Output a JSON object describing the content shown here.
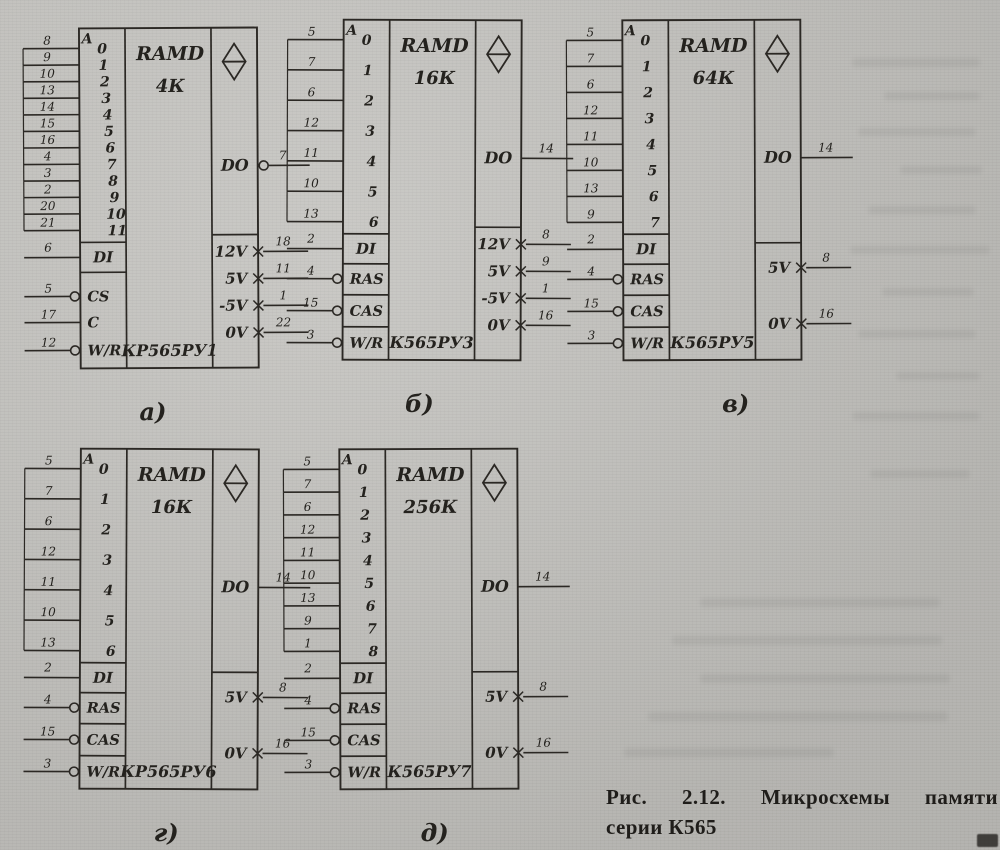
{
  "caption": {
    "line1": "Рис. 2.12. Микросхемы памяти",
    "line2": "серии К565"
  },
  "chips": [
    {
      "label": "а)",
      "type_label": "RAMD",
      "capacity": "4К",
      "part": "КР565РУ1",
      "addr_prefix": "A",
      "addresses": [
        {
          "bit": "0",
          "pin": "8"
        },
        {
          "bit": "1",
          "pin": "9"
        },
        {
          "bit": "2",
          "pin": "10"
        },
        {
          "bit": "3",
          "pin": "13"
        },
        {
          "bit": "4",
          "pin": "14"
        },
        {
          "bit": "5",
          "pin": "15"
        },
        {
          "bit": "6",
          "pin": "16"
        },
        {
          "bit": "7",
          "pin": "4"
        },
        {
          "bit": "8",
          "pin": "3"
        },
        {
          "bit": "9",
          "pin": "2"
        },
        {
          "bit": "10",
          "pin": "20"
        },
        {
          "bit": "11",
          "pin": "21"
        }
      ],
      "data_in": {
        "label": "DI",
        "pin": "6"
      },
      "controls": [
        {
          "label": "CS",
          "pin": "5",
          "circle": true
        },
        {
          "label": "C",
          "pin": "17",
          "circle": false
        },
        {
          "label": "W/R",
          "pin": "12",
          "circle": true
        }
      ],
      "boxed_controls": false,
      "data_out": {
        "label": "DO",
        "pin": "7",
        "circle": true
      },
      "power": [
        {
          "label": "12V",
          "pin": "18"
        },
        {
          "label": "5V",
          "pin": "11"
        },
        {
          "label": "-5V",
          "pin": "1"
        },
        {
          "label": "0V",
          "pin": "22"
        }
      ]
    },
    {
      "label": "б)",
      "type_label": "RAMD",
      "capacity": "16К",
      "part": "К565РУ3",
      "addr_prefix": "A",
      "addresses": [
        {
          "bit": "0",
          "pin": "5"
        },
        {
          "bit": "1",
          "pin": "7"
        },
        {
          "bit": "2",
          "pin": "6"
        },
        {
          "bit": "3",
          "pin": "12"
        },
        {
          "bit": "4",
          "pin": "11"
        },
        {
          "bit": "5",
          "pin": "10"
        },
        {
          "bit": "6",
          "pin": "13"
        }
      ],
      "data_in": {
        "label": "DI",
        "pin": "2"
      },
      "controls": [
        {
          "label": "RAS",
          "pin": "4",
          "circle": true
        },
        {
          "label": "CAS",
          "pin": "15",
          "circle": true
        },
        {
          "label": "W/R",
          "pin": "3",
          "circle": true
        }
      ],
      "boxed_controls": true,
      "data_out": {
        "label": "DO",
        "pin": "14",
        "circle": false
      },
      "power": [
        {
          "label": "12V",
          "pin": "8"
        },
        {
          "label": "5V",
          "pin": "9"
        },
        {
          "label": "-5V",
          "pin": "1"
        },
        {
          "label": "0V",
          "pin": "16"
        }
      ]
    },
    {
      "label": "в)",
      "type_label": "RAMD",
      "capacity": "64К",
      "part": "К565РУ5",
      "addr_prefix": "A",
      "addresses": [
        {
          "bit": "0",
          "pin": "5"
        },
        {
          "bit": "1",
          "pin": "7"
        },
        {
          "bit": "2",
          "pin": "6"
        },
        {
          "bit": "3",
          "pin": "12"
        },
        {
          "bit": "4",
          "pin": "11"
        },
        {
          "bit": "5",
          "pin": "10"
        },
        {
          "bit": "6",
          "pin": "13"
        },
        {
          "bit": "7",
          "pin": "9"
        }
      ],
      "data_in": {
        "label": "DI",
        "pin": "2"
      },
      "controls": [
        {
          "label": "RAS",
          "pin": "4",
          "circle": true
        },
        {
          "label": "CAS",
          "pin": "15",
          "circle": true
        },
        {
          "label": "W/R",
          "pin": "3",
          "circle": true
        }
      ],
      "boxed_controls": true,
      "data_out": {
        "label": "DO",
        "pin": "14",
        "circle": false
      },
      "power": [
        {
          "label": "5V",
          "pin": "8"
        },
        {
          "label": "0V",
          "pin": "16"
        }
      ]
    },
    {
      "label": "г)",
      "type_label": "RAMD",
      "capacity": "16К",
      "part": "КР565РУ6",
      "addr_prefix": "A",
      "addresses": [
        {
          "bit": "0",
          "pin": "5"
        },
        {
          "bit": "1",
          "pin": "7"
        },
        {
          "bit": "2",
          "pin": "6"
        },
        {
          "bit": "3",
          "pin": "12"
        },
        {
          "bit": "4",
          "pin": "11"
        },
        {
          "bit": "5",
          "pin": "10"
        },
        {
          "bit": "6",
          "pin": "13"
        }
      ],
      "data_in": {
        "label": "DI",
        "pin": "2"
      },
      "controls": [
        {
          "label": "RAS",
          "pin": "4",
          "circle": true
        },
        {
          "label": "CAS",
          "pin": "15",
          "circle": true
        },
        {
          "label": "W/R",
          "pin": "3",
          "circle": true
        }
      ],
      "boxed_controls": true,
      "data_out": {
        "label": "DO",
        "pin": "14",
        "circle": false
      },
      "power": [
        {
          "label": "5V",
          "pin": "8"
        },
        {
          "label": "0V",
          "pin": "16"
        }
      ]
    },
    {
      "label": "д)",
      "type_label": "RAMD",
      "capacity": "256К",
      "part": "К565РУ7",
      "addr_prefix": "A",
      "addresses": [
        {
          "bit": "0",
          "pin": "5"
        },
        {
          "bit": "1",
          "pin": "7"
        },
        {
          "bit": "2",
          "pin": "6"
        },
        {
          "bit": "3",
          "pin": "12"
        },
        {
          "bit": "4",
          "pin": "11"
        },
        {
          "bit": "5",
          "pin": "10"
        },
        {
          "bit": "6",
          "pin": "13"
        },
        {
          "bit": "7",
          "pin": "9"
        },
        {
          "bit": "8",
          "pin": "1"
        }
      ],
      "data_in": {
        "label": "DI",
        "pin": "2"
      },
      "controls": [
        {
          "label": "RAS",
          "pin": "4",
          "circle": true
        },
        {
          "label": "CAS",
          "pin": "15",
          "circle": true
        },
        {
          "label": "W/R",
          "pin": "3",
          "circle": true
        }
      ],
      "boxed_controls": true,
      "data_out": {
        "label": "DO",
        "pin": "14",
        "circle": false
      },
      "power": [
        {
          "label": "5V",
          "pin": "8"
        },
        {
          "label": "0V",
          "pin": "16"
        }
      ]
    }
  ]
}
